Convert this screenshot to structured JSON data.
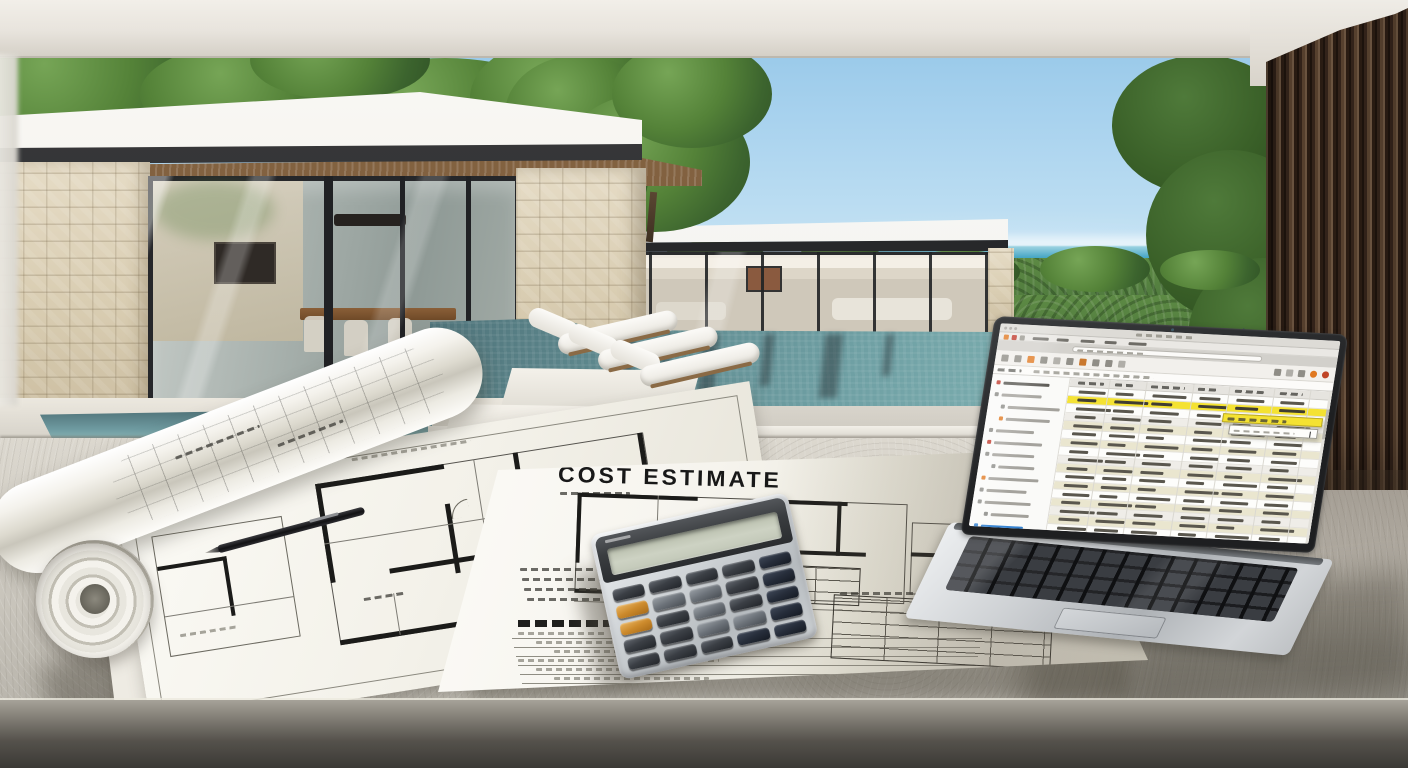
{
  "document": {
    "title": "COST ESTIMATE"
  },
  "palette": {
    "sky_top": "#8fc3e6",
    "ocean": "#2b8cab",
    "foliage": "#3c642e",
    "pool_deep": "#435f64",
    "pool_shallow": "#8fc0bf",
    "stone": "#d9cdb2",
    "wood_soffit": "#74563a",
    "slat_wood": "#33231a",
    "roof_white": "#efece6",
    "table": "#d2cec5",
    "paper": "#f3f1e9",
    "ink": "#181818",
    "calculator_body": "#d4d8db",
    "calculator_key": "#3b3f45",
    "calculator_accent": "#cc8a2c",
    "screen_highlight": "#f4e232",
    "screen_row_alt": "#eae6cf",
    "screen_accent_orange": "#e07820",
    "screen_accent_red": "#c0392b",
    "screen_accent_blue": "#2f7fd0"
  },
  "laptop_screen": {
    "app_icons": [
      "#e07820",
      "#c0392b",
      "#9a988f"
    ],
    "toolbar": {
      "left_icons": [
        "#8f8d86",
        "#8f8d86",
        "#e07820",
        "#8f8d86",
        "#b0aea8",
        "#8f8d86",
        "#c8762a",
        "#8f8d86",
        "#8f8d86",
        "#b0aea8"
      ],
      "right_icons": [
        "#8f8d86",
        "#b0aea8",
        "#8f8d86",
        "#e07820",
        "#bf4426"
      ]
    },
    "sidebar_items": [
      {
        "color": "#c0392b",
        "width": 46,
        "indent": 0
      },
      {
        "color": "#8a8a86",
        "width": 40,
        "indent": 0
      },
      {
        "color": "#8a8a86",
        "width": 52,
        "indent": 1
      },
      {
        "color": "#e07820",
        "width": 44,
        "indent": 1
      },
      {
        "color": "#8a8a86",
        "width": 38,
        "indent": 0
      },
      {
        "color": "#c0392b",
        "width": 48,
        "indent": 0
      },
      {
        "color": "#8a8a86",
        "width": 42,
        "indent": 0
      },
      {
        "color": "#8a8a86",
        "width": 36,
        "indent": 1
      },
      {
        "color": "#e07820",
        "width": 50,
        "indent": 0
      },
      {
        "color": "#8a8a86",
        "width": 40,
        "indent": 0
      },
      {
        "color": "#8a8a86",
        "width": 46,
        "indent": 0
      },
      {
        "color": "#8a8a86",
        "width": 38,
        "indent": 1
      },
      {
        "color": "#2f7fd0",
        "width": 42,
        "indent": 0
      }
    ],
    "grid": {
      "columns": 6,
      "rows": [
        "plain",
        "highlight",
        "plain",
        "gray",
        "beige",
        "plain",
        "beige",
        "plain",
        "gray",
        "beige",
        "plain",
        "beige",
        "plain",
        "beige",
        "gray",
        "beige",
        "plain"
      ]
    }
  },
  "calculator": {
    "key_count": 25,
    "accent_keys": [
      5,
      10
    ],
    "dark_keys": [
      4,
      9,
      14,
      19,
      23,
      24
    ],
    "light_keys": [
      6,
      7,
      12,
      17,
      18
    ]
  }
}
